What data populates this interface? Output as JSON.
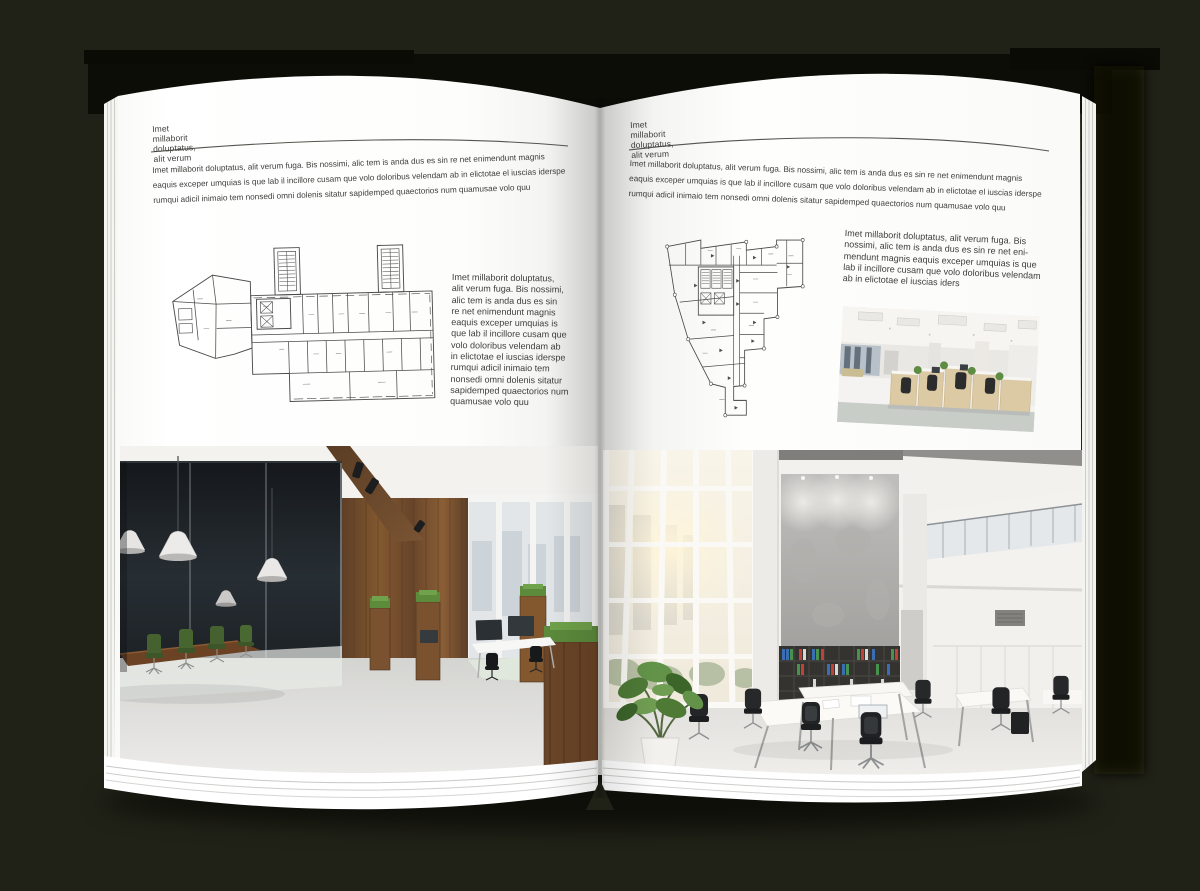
{
  "colors": {
    "background": "#212217",
    "page": "#ffffff",
    "text": "#3e3d3b",
    "header_rule": "#55544f",
    "wood_accent": "#7a5230",
    "plant_green": "#5d8c42",
    "binder_blue": "#3a6db3",
    "binder_green": "#47934d",
    "binder_red": "#c04138"
  },
  "left_page": {
    "header": "Imet millaborit doluptatus, alit verum",
    "intro_lines": [
      "Imet millaborit doluptatus, alit verum fuga. Bis nossimi, alic tem is anda dus es sin re net enimendunt magnis",
      "eaquis exceper umquias is que lab il incillore cusam que volo doloribus velendam ab in elictotae el iuscias iderspe",
      "rumqui adicil inimaio tem nonsedi omni dolenis sitatur sapidemped quaectorios num quamusae volo quu"
    ],
    "side_lines": [
      "Imet millaborit doluptatus,",
      "alit verum fuga. Bis nossimi,",
      "alic tem is anda dus es sin",
      "re net enimendunt magnis",
      "eaquis exceper umquias is",
      "que lab il incillore cusam que",
      "volo doloribus velendam ab",
      "in elictotae el iuscias iderspe",
      "rumqui adicil inimaio tem",
      "nonsedi omni dolenis sitatur",
      "sapidemped quaectorios num",
      "quamusae volo quu"
    ],
    "figures": {
      "floor_plan": "wide-wing-floor-plan",
      "photo": "loft-office-with-glass-meeting-room"
    }
  },
  "right_page": {
    "header": "Imet millaborit doluptatus, alit verum",
    "intro_lines": [
      "Imet millaborit doluptatus, alit verum fuga. Bis nossimi, alic tem is anda dus es sin re net enimendunt magnis",
      "eaquis exceper umquias is que lab il incillore cusam que volo doloribus velendam ab in elictotae el iuscias iderspe",
      "rumqui adicil inimaio tem nonsedi omni dolenis sitatur sapidemped quaectorios num quamusae volo quu"
    ],
    "side_lines": [
      "Imet millaborit doluptatus, alit verum fuga. Bis",
      "nossimi, alic tem is anda dus es sin re net eni-",
      "mendunt magnis eaquis exceper umquias is que",
      "lab il incillore cusam que volo doloribus velendam",
      "ab in elictotae el iuscias iders"
    ],
    "figures": {
      "floor_plan": "tower-floor-plan",
      "photo_small": "open-plan-office-cubicles",
      "photo_large": "atrium-office-with-bookshelf"
    }
  }
}
